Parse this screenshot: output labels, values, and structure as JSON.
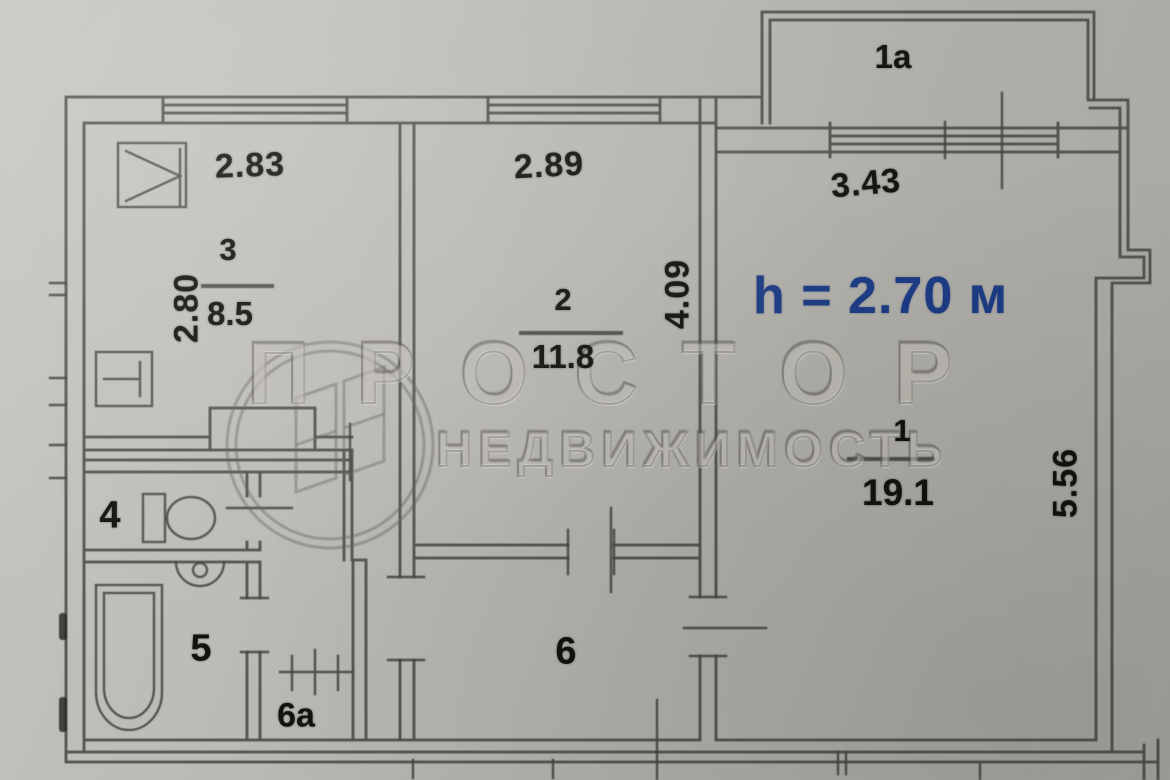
{
  "plan": {
    "balcony_label": "1a",
    "height_note": "h = 2.70 м",
    "rooms": {
      "room1": {
        "number": "1",
        "area": "19.1"
      },
      "room2": {
        "number": "2",
        "area": "11.8"
      },
      "room3": {
        "number": "3",
        "area": "8.5"
      },
      "room4": {
        "number": "4"
      },
      "room5": {
        "number": "5"
      },
      "room6": {
        "number": "6"
      },
      "room6a": {
        "number": "6a"
      }
    },
    "dimensions": {
      "kitchen_width": "2.83",
      "room2_width": "2.89",
      "room1_width": "3.43",
      "kitchen_depth": "2.80",
      "room2_depth": "4.09",
      "room1_depth": "5.56"
    },
    "colors": {
      "paper": "#b7b5b0",
      "line": "#43423e",
      "height_text": "#1d3c85"
    }
  },
  "watermark": {
    "title": "ПРОСТОР",
    "subtitle": "НЕДВИЖИМОСТЬ"
  }
}
